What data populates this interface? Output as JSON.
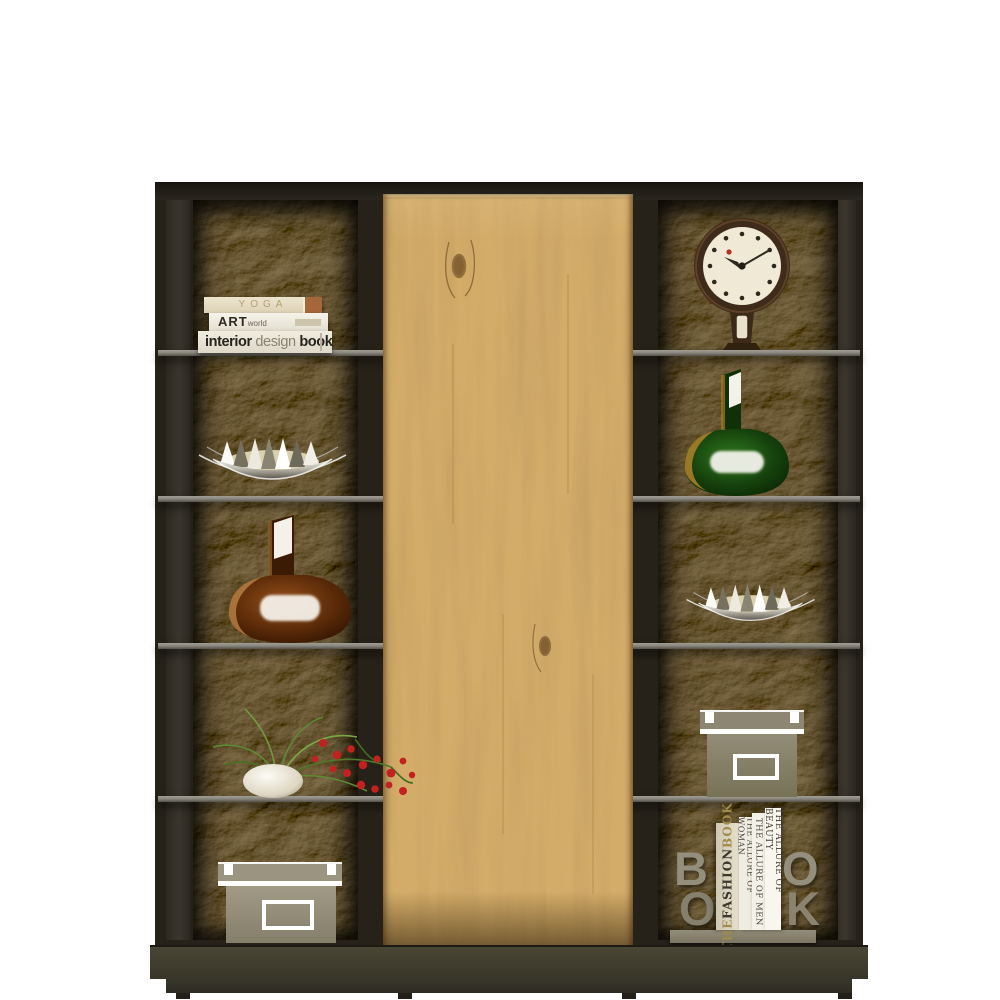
{
  "scene": {
    "description": "Product photo of a display cabinet with rough dark stone shelf backs, a light oak sliding center door and decorative styling items",
    "background_color": "#ffffff"
  },
  "cabinet": {
    "frame_color": "#262219",
    "stone_tint": "#6b6152",
    "wood_light": "#d7b273",
    "wood_grain": "#6b4418",
    "shelf_color": "#8b887f",
    "base_color": "#4a4635",
    "plinth_color": "#3a372c",
    "shelf_line_count": 4,
    "column_cells_per_side": 5
  },
  "items": {
    "book_stack": {
      "top_book": {
        "title": "YOGA",
        "spine_color": "#e7dfc9",
        "accent_color": "#a4673a"
      },
      "middle_book": {
        "title_bold": "ART",
        "title_light": "world",
        "spine_color": "#f4f1e8"
      },
      "bottom_book": {
        "word1": "interior",
        "word2": " design",
        "word3": " book",
        "spine_color": "#ebe7da"
      }
    },
    "clock": {
      "frame_color": "#4a3320",
      "face_color": "#efe9d6",
      "marker_color": "#2f281f",
      "alarm_dot_color": "#b23020"
    },
    "silver_bowl_left": {
      "metal_light": "#f5f4ef",
      "metal_dark": "#6e6a60",
      "inner_color": "#d9d0ae"
    },
    "silver_bowl_right": {
      "metal_light": "#f5f4ef",
      "metal_dark": "#6e6a60",
      "inner_color": "#d9d0ae"
    },
    "green_vase": {
      "glass_color": "#1d4a12",
      "rim_color": "#b9872b",
      "highlight_color": "#f2f2ea"
    },
    "brown_vase": {
      "glass_color": "#5e2c08",
      "rim_color": "#c28a4a",
      "highlight_color": "#f5f0e8"
    },
    "plant": {
      "pot_color": "#efeadb",
      "stem_color": "#5d8a33",
      "berry_color": "#c32020"
    },
    "box_right": {
      "body_color": "#8d8672",
      "trim_color": "#ffffff"
    },
    "box_bottom_left": {
      "body_color": "#9a9480",
      "trim_color": "#ffffff"
    },
    "book_display": {
      "left_letters": [
        "B",
        "O"
      ],
      "right_letters": [
        "O",
        "K"
      ],
      "letter_color": "#948e7c",
      "spines": [
        {
          "word1": "THE ",
          "word2": "FASHION ",
          "word3": "BOOK",
          "color": "#ded8c4",
          "accent_color": "#a08a4c"
        },
        {
          "title": "THE ALLURE OF WOMAN",
          "color": "#efece1"
        },
        {
          "title": "THE ALLURE OF MEN",
          "color": "#f4f1e8"
        },
        {
          "title": "THE ALLURE OF BEAUTY",
          "color": "#f8f6ef"
        }
      ]
    }
  }
}
